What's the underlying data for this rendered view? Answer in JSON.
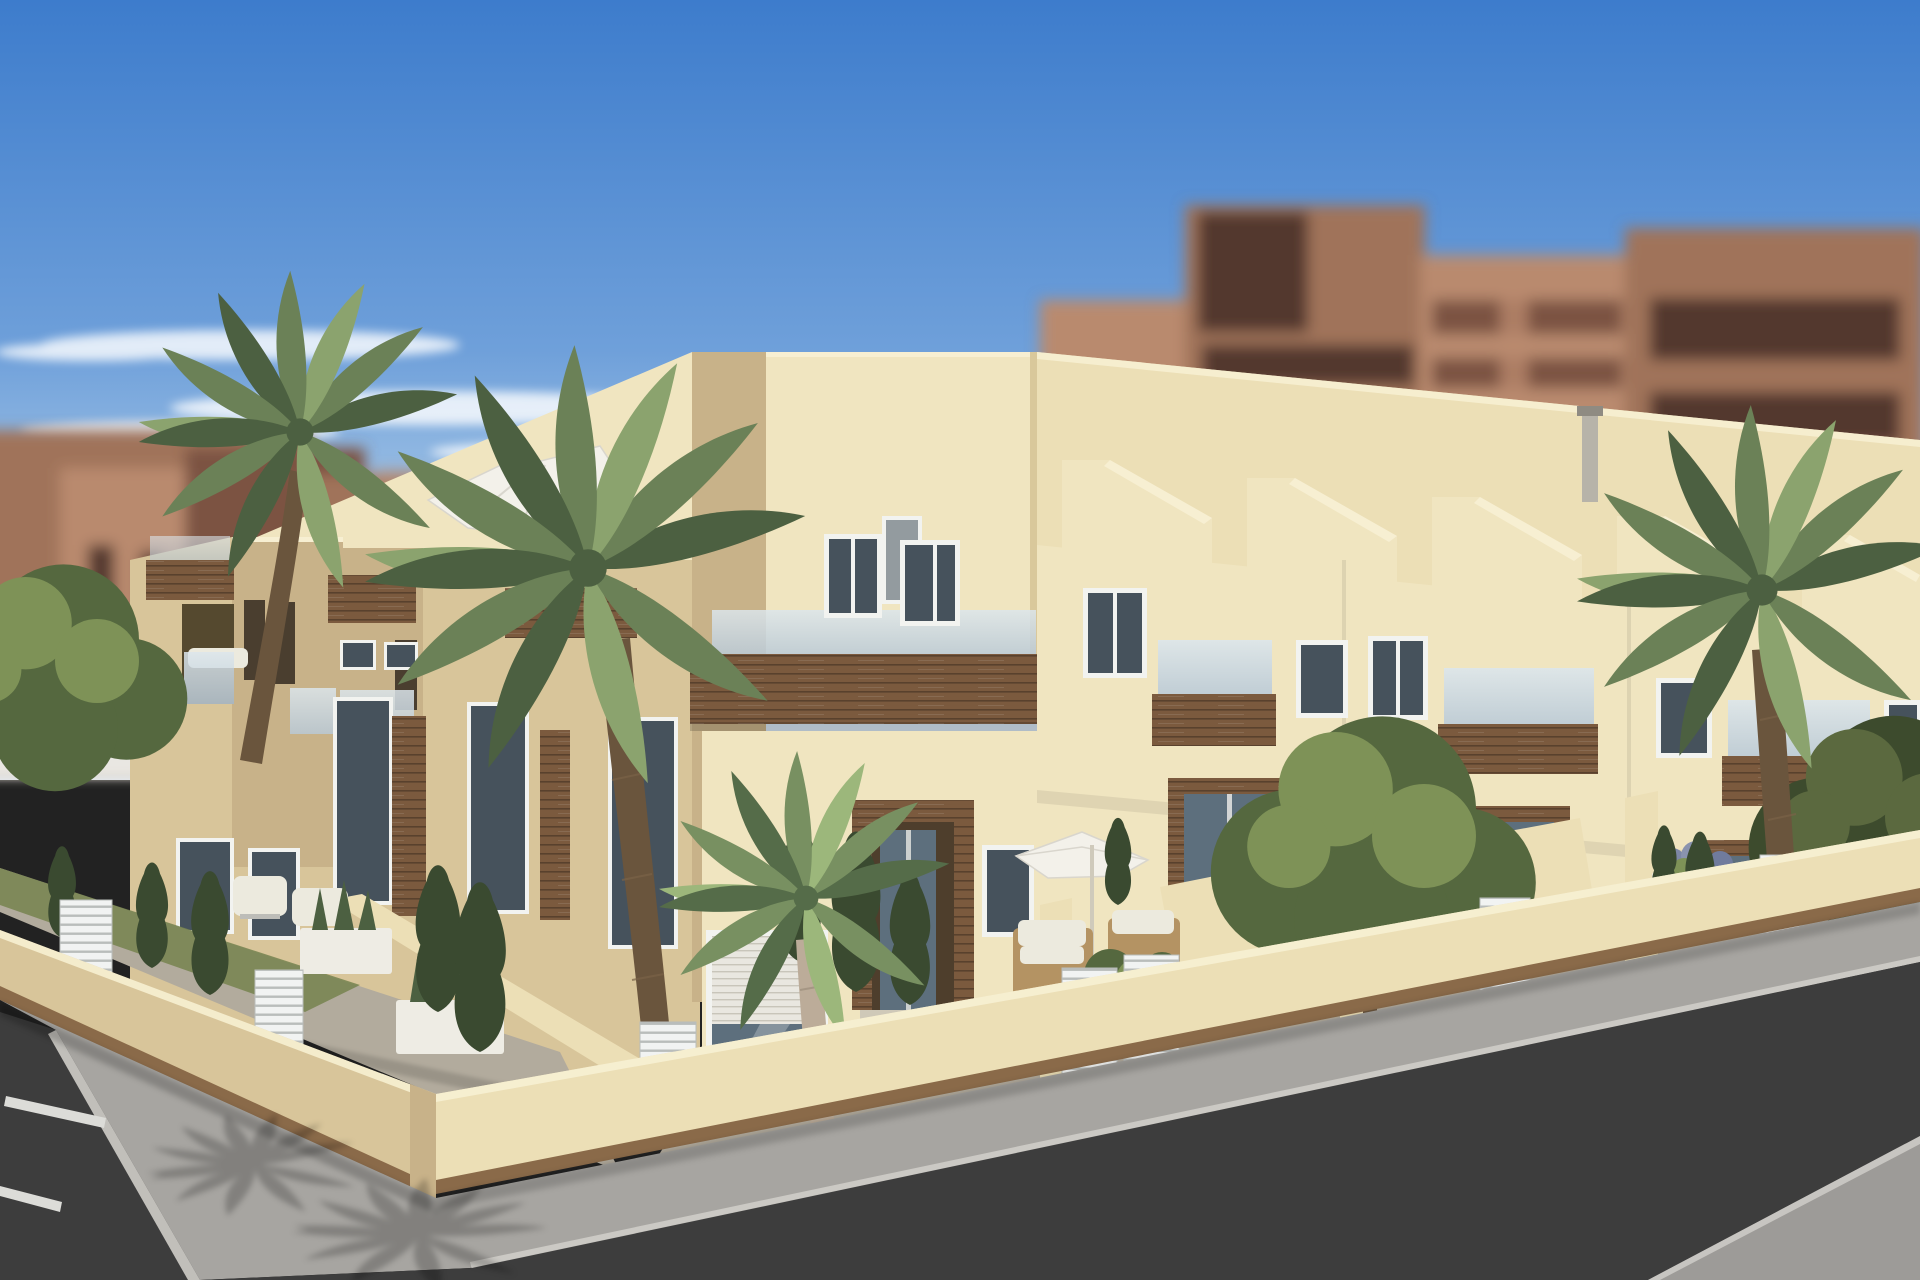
{
  "meta": {
    "title": "New-build corner townhouse complex - exterior 3D render",
    "width_px": 1920,
    "height_px": 1280
  },
  "labels": {
    "scene_title": "3D architectural render of a cream corner block of townhouses with wood-clad balconies",
    "sky": "Blue sky with thin white clouds",
    "background_city": "Out-of-focus red-brown apartment towers",
    "white_building": "Out-of-focus light building at left",
    "building": "Cream townhouse block with wood beams, glass balustrades and roof terraces",
    "roof_terraces": "Roof terraces with white cantilever parasol, chimney and stair bulkheads",
    "garden": "Walled front gardens with palms, cypresses, planters and patio furniture",
    "street_left": "Asphalt street with white parking lines",
    "street_right": "Asphalt street with gray sidewalks",
    "fence": "Cream perimeter wall with white slatted gates"
  },
  "palette": {
    "sky_top": "#3d7ccc",
    "sky_mid": "#6fa0da",
    "sky_low": "#b7d3eb",
    "sky_horizon": "#e2edf6",
    "cloud_white": "#ffffff",
    "bg_brick_light": "#b98a6e",
    "bg_brick_mid": "#a0735a",
    "bg_brick_dark": "#7c5242",
    "bg_window_dark": "#53392e",
    "bg_white_building": "#e9e7e2",
    "wall_sunlit": "#f0e5c0",
    "wall_sunlit_bright": "#f7efd2",
    "wall_parapet": "#ecdfb6",
    "wall_shaded": "#d8c59a",
    "wall_shaded_deep": "#c8b289",
    "wood_brown": "#7b5a3e",
    "wood_dark": "#5f4430",
    "wood_base": "#8a6a49",
    "glass_blue": "#b9c9d6",
    "glass_light": "#dce6ec",
    "window_glass_dark": "#46525c",
    "frame_white": "#f2f3f0",
    "shutter_white": "#e9e7e0",
    "door_glass": "#5d6f7d",
    "palm_green_mid": "#6b8157",
    "palm_green_dark": "#4c6041",
    "palm_green_light": "#8ba36e",
    "leaf_tree_dark": "#55683f",
    "leaf_tree_light": "#7e9257",
    "cypress_green": "#3a4a30",
    "grass_green": "#76834f",
    "trunk_brown": "#6a553d",
    "trunk_gray": "#a89a89",
    "pavement_warm": "#b2ab9d",
    "sidewalk_gray": "#a7a5a1",
    "sidewalk_light": "#9d9b98",
    "asphalt_dark": "#3d3d3d",
    "curb_light": "#cfcdc8",
    "fence_white": "#f1f3f2",
    "fence_line": "#b9bdbb",
    "umbrella_white": "#f3f1ea",
    "wicker_tan": "#b49363",
    "cushion_white": "#eceade",
    "planter_white": "#eeece4",
    "shadow_black": "#000000"
  }
}
